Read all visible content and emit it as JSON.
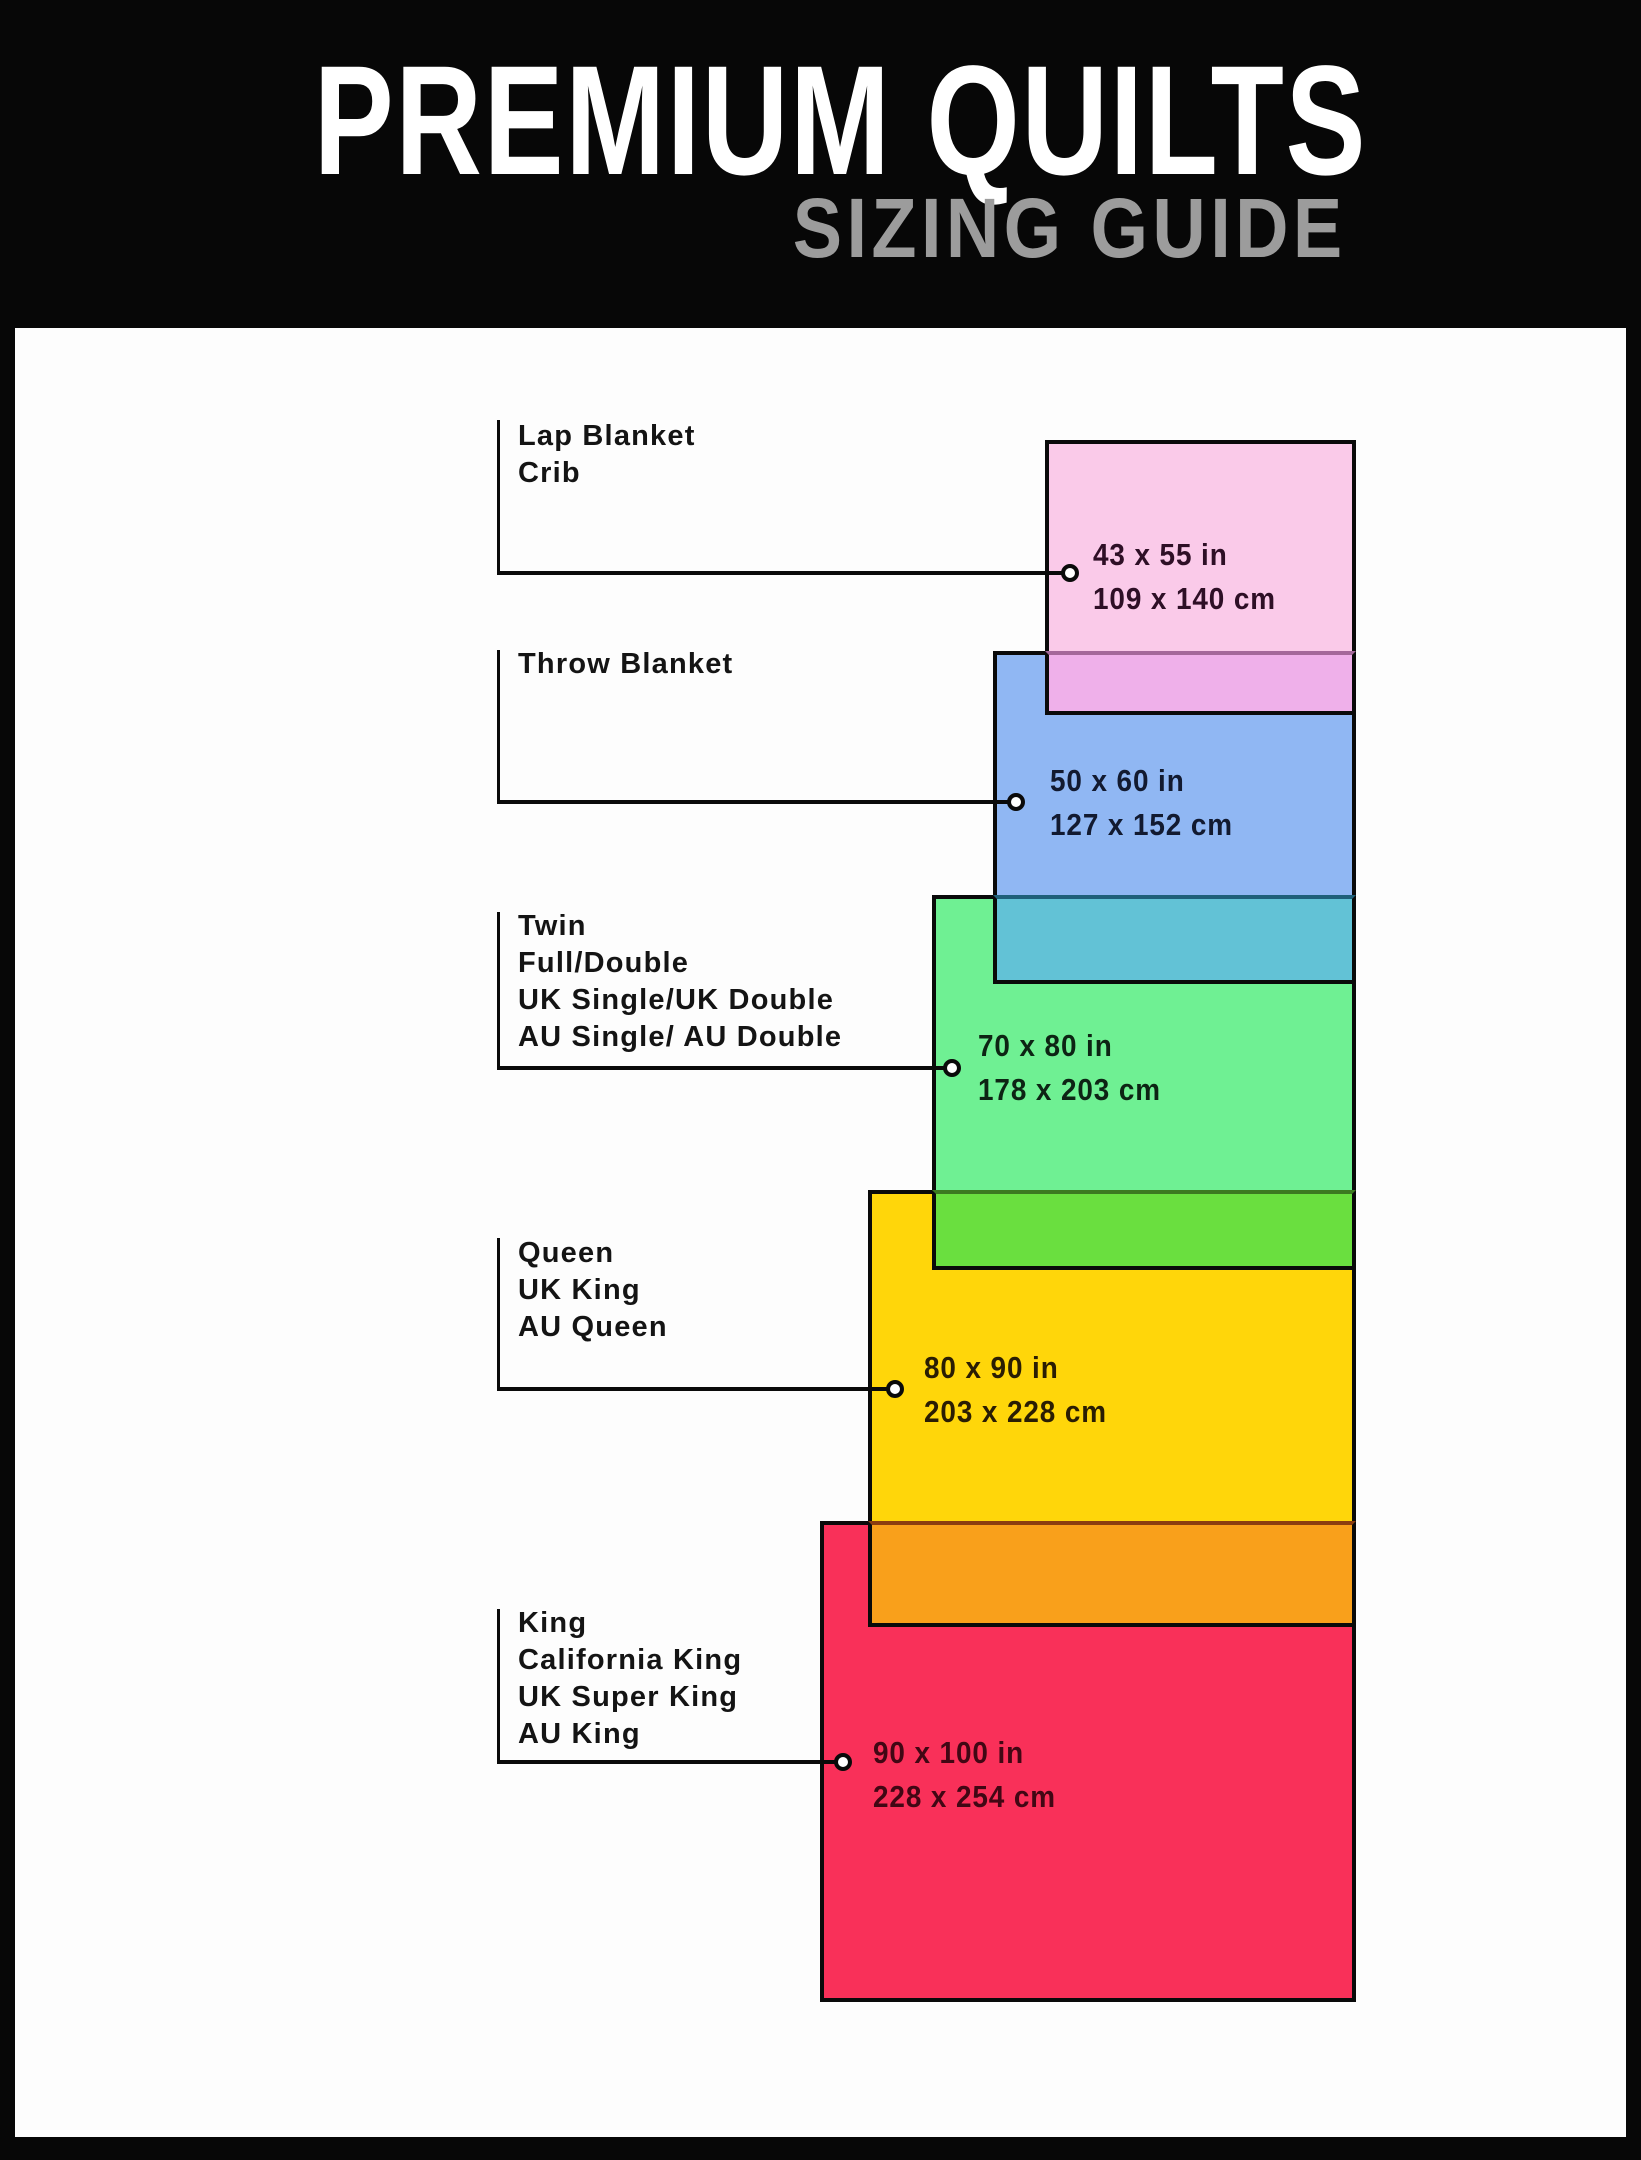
{
  "header": {
    "title": "PREMIUM QUILTS",
    "subtitle": "SIZING GUIDE",
    "bg_color": "#070707",
    "title_color": "#FFFFFF",
    "subtitle_color": "#9C9C9C"
  },
  "panel": {
    "bg_color": "#FDFDFD"
  },
  "line_color": "#0A0A0A",
  "sizes": [
    {
      "id": "lap-blanket",
      "labels": [
        "Lap Blanket",
        "Crib"
      ],
      "inches": "43 x 55 in",
      "cm": "109 x 140 cm",
      "fill": "#FACAE9",
      "dim_text_color": "#2E0F26",
      "layout": {
        "rect": {
          "x": 1045,
          "y": 440,
          "w": 311,
          "h": 275
        },
        "label_left": 518,
        "label_top": 418,
        "vline_x": 497,
        "vline_top": 420,
        "line_y": 571,
        "line_x1": 498,
        "circle_cx": 1070,
        "dim_x": 1093,
        "dim_top": 533
      }
    },
    {
      "id": "throw-blanket",
      "labels": [
        "Throw Blanket"
      ],
      "inches": "50 x 60 in",
      "cm": "127 x 152 cm",
      "fill": "#90B7F3",
      "dim_text_color": "#121A30",
      "layout": {
        "rect": {
          "x": 993,
          "y": 651,
          "w": 363,
          "h": 333
        },
        "label_left": 518,
        "label_top": 646,
        "vline_x": 497,
        "vline_top": 650,
        "line_y": 800,
        "line_x1": 498,
        "circle_cx": 1016,
        "dim_x": 1050,
        "dim_top": 759
      }
    },
    {
      "id": "twin",
      "labels": [
        "Twin",
        "Full/Double",
        "UK Single/UK Double",
        "AU Single/ AU Double"
      ],
      "inches": "70 x 80 in",
      "cm": "178 x 203 cm",
      "fill": "#6FF093",
      "dim_text_color": "#0D2414",
      "layout": {
        "rect": {
          "x": 932,
          "y": 895,
          "w": 424,
          "h": 375
        },
        "label_left": 518,
        "label_top": 908,
        "vline_x": 497,
        "vline_top": 912,
        "line_y": 1066,
        "line_x1": 498,
        "circle_cx": 952,
        "dim_x": 978,
        "dim_top": 1024
      }
    },
    {
      "id": "queen",
      "labels": [
        "Queen",
        "UK King",
        "AU Queen"
      ],
      "inches": "80 x 90 in",
      "cm": "203 x 228 cm",
      "fill": "#FFD60A",
      "dim_text_color": "#2A1D03",
      "layout": {
        "rect": {
          "x": 868,
          "y": 1190,
          "w": 488,
          "h": 437
        },
        "label_left": 518,
        "label_top": 1235,
        "vline_x": 497,
        "vline_top": 1238,
        "line_y": 1387,
        "line_x1": 498,
        "circle_cx": 895,
        "dim_x": 924,
        "dim_top": 1346
      }
    },
    {
      "id": "king",
      "labels": [
        "King",
        "California King",
        "UK Super King",
        "AU King"
      ],
      "inches": "90 x 100 in",
      "cm": "228 x 254 cm",
      "fill": "#F93059",
      "dim_text_color": "#410714",
      "layout": {
        "rect": {
          "x": 820,
          "y": 1521,
          "w": 536,
          "h": 481
        },
        "label_left": 518,
        "label_top": 1605,
        "vline_x": 497,
        "vline_top": 1609,
        "line_y": 1760,
        "line_x1": 498,
        "circle_cx": 843,
        "dim_x": 873,
        "dim_top": 1731
      }
    }
  ],
  "overlaps": [
    {
      "between": "lap-blanket-over-throw-blanket",
      "x": 1045,
      "y": 651,
      "w": 311,
      "h": 64,
      "fill": "#EFB0EA",
      "top_line": "#A4689A"
    },
    {
      "between": "throw-blanket-over-twin",
      "x": 993,
      "y": 895,
      "w": 363,
      "h": 89,
      "fill": "#62C2D6",
      "top_line": "#1F607A"
    },
    {
      "between": "twin-over-queen",
      "x": 932,
      "y": 1190,
      "w": 424,
      "h": 80,
      "fill": "#6ADF3F",
      "top_line": "#3C7A20"
    },
    {
      "between": "queen-over-king",
      "x": 868,
      "y": 1521,
      "w": 488,
      "h": 106,
      "fill": "#F9A01B",
      "top_line": "#8B3D10"
    }
  ]
}
